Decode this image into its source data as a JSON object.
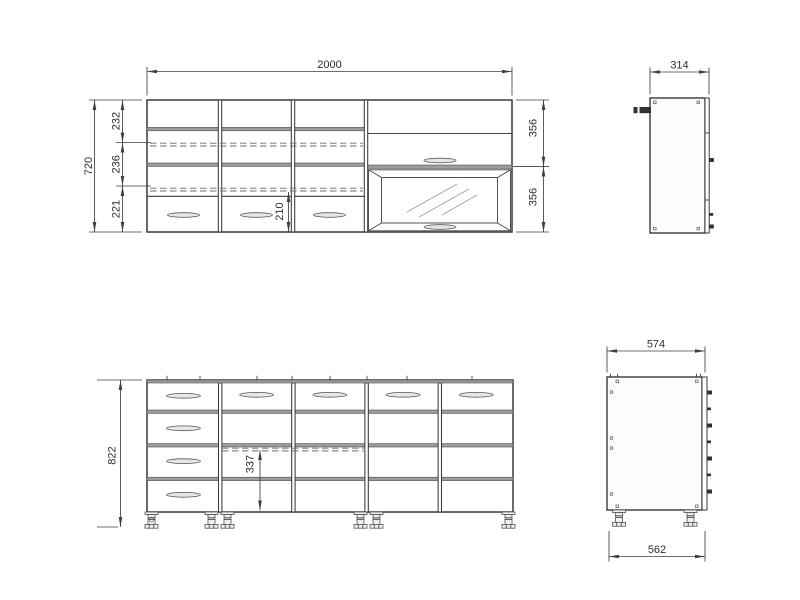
{
  "drawing": {
    "colors": {
      "background": "#ffffff",
      "line": "#3a3a3a",
      "dimension": "#3f3f3f",
      "shelf_band": "#9c9c9c",
      "hardware": "#323232",
      "handle_fill": "#e6e6e6"
    },
    "views": {
      "wall_cabinet_front": {
        "dims": {
          "width": "2000",
          "height": "720",
          "shelf_top": "232",
          "shelf_middle": "236",
          "shelf_bottom": "221",
          "drawer_height": "210",
          "flap_upper": "356",
          "flap_lower": "356"
        }
      },
      "wall_cabinet_side": {
        "dims": {
          "depth": "314"
        }
      },
      "base_cabinet_front": {
        "dims": {
          "height": "822",
          "inner_height": "337"
        }
      },
      "base_cabinet_side": {
        "dims": {
          "depth_top": "574",
          "depth_bottom": "562"
        }
      }
    }
  }
}
